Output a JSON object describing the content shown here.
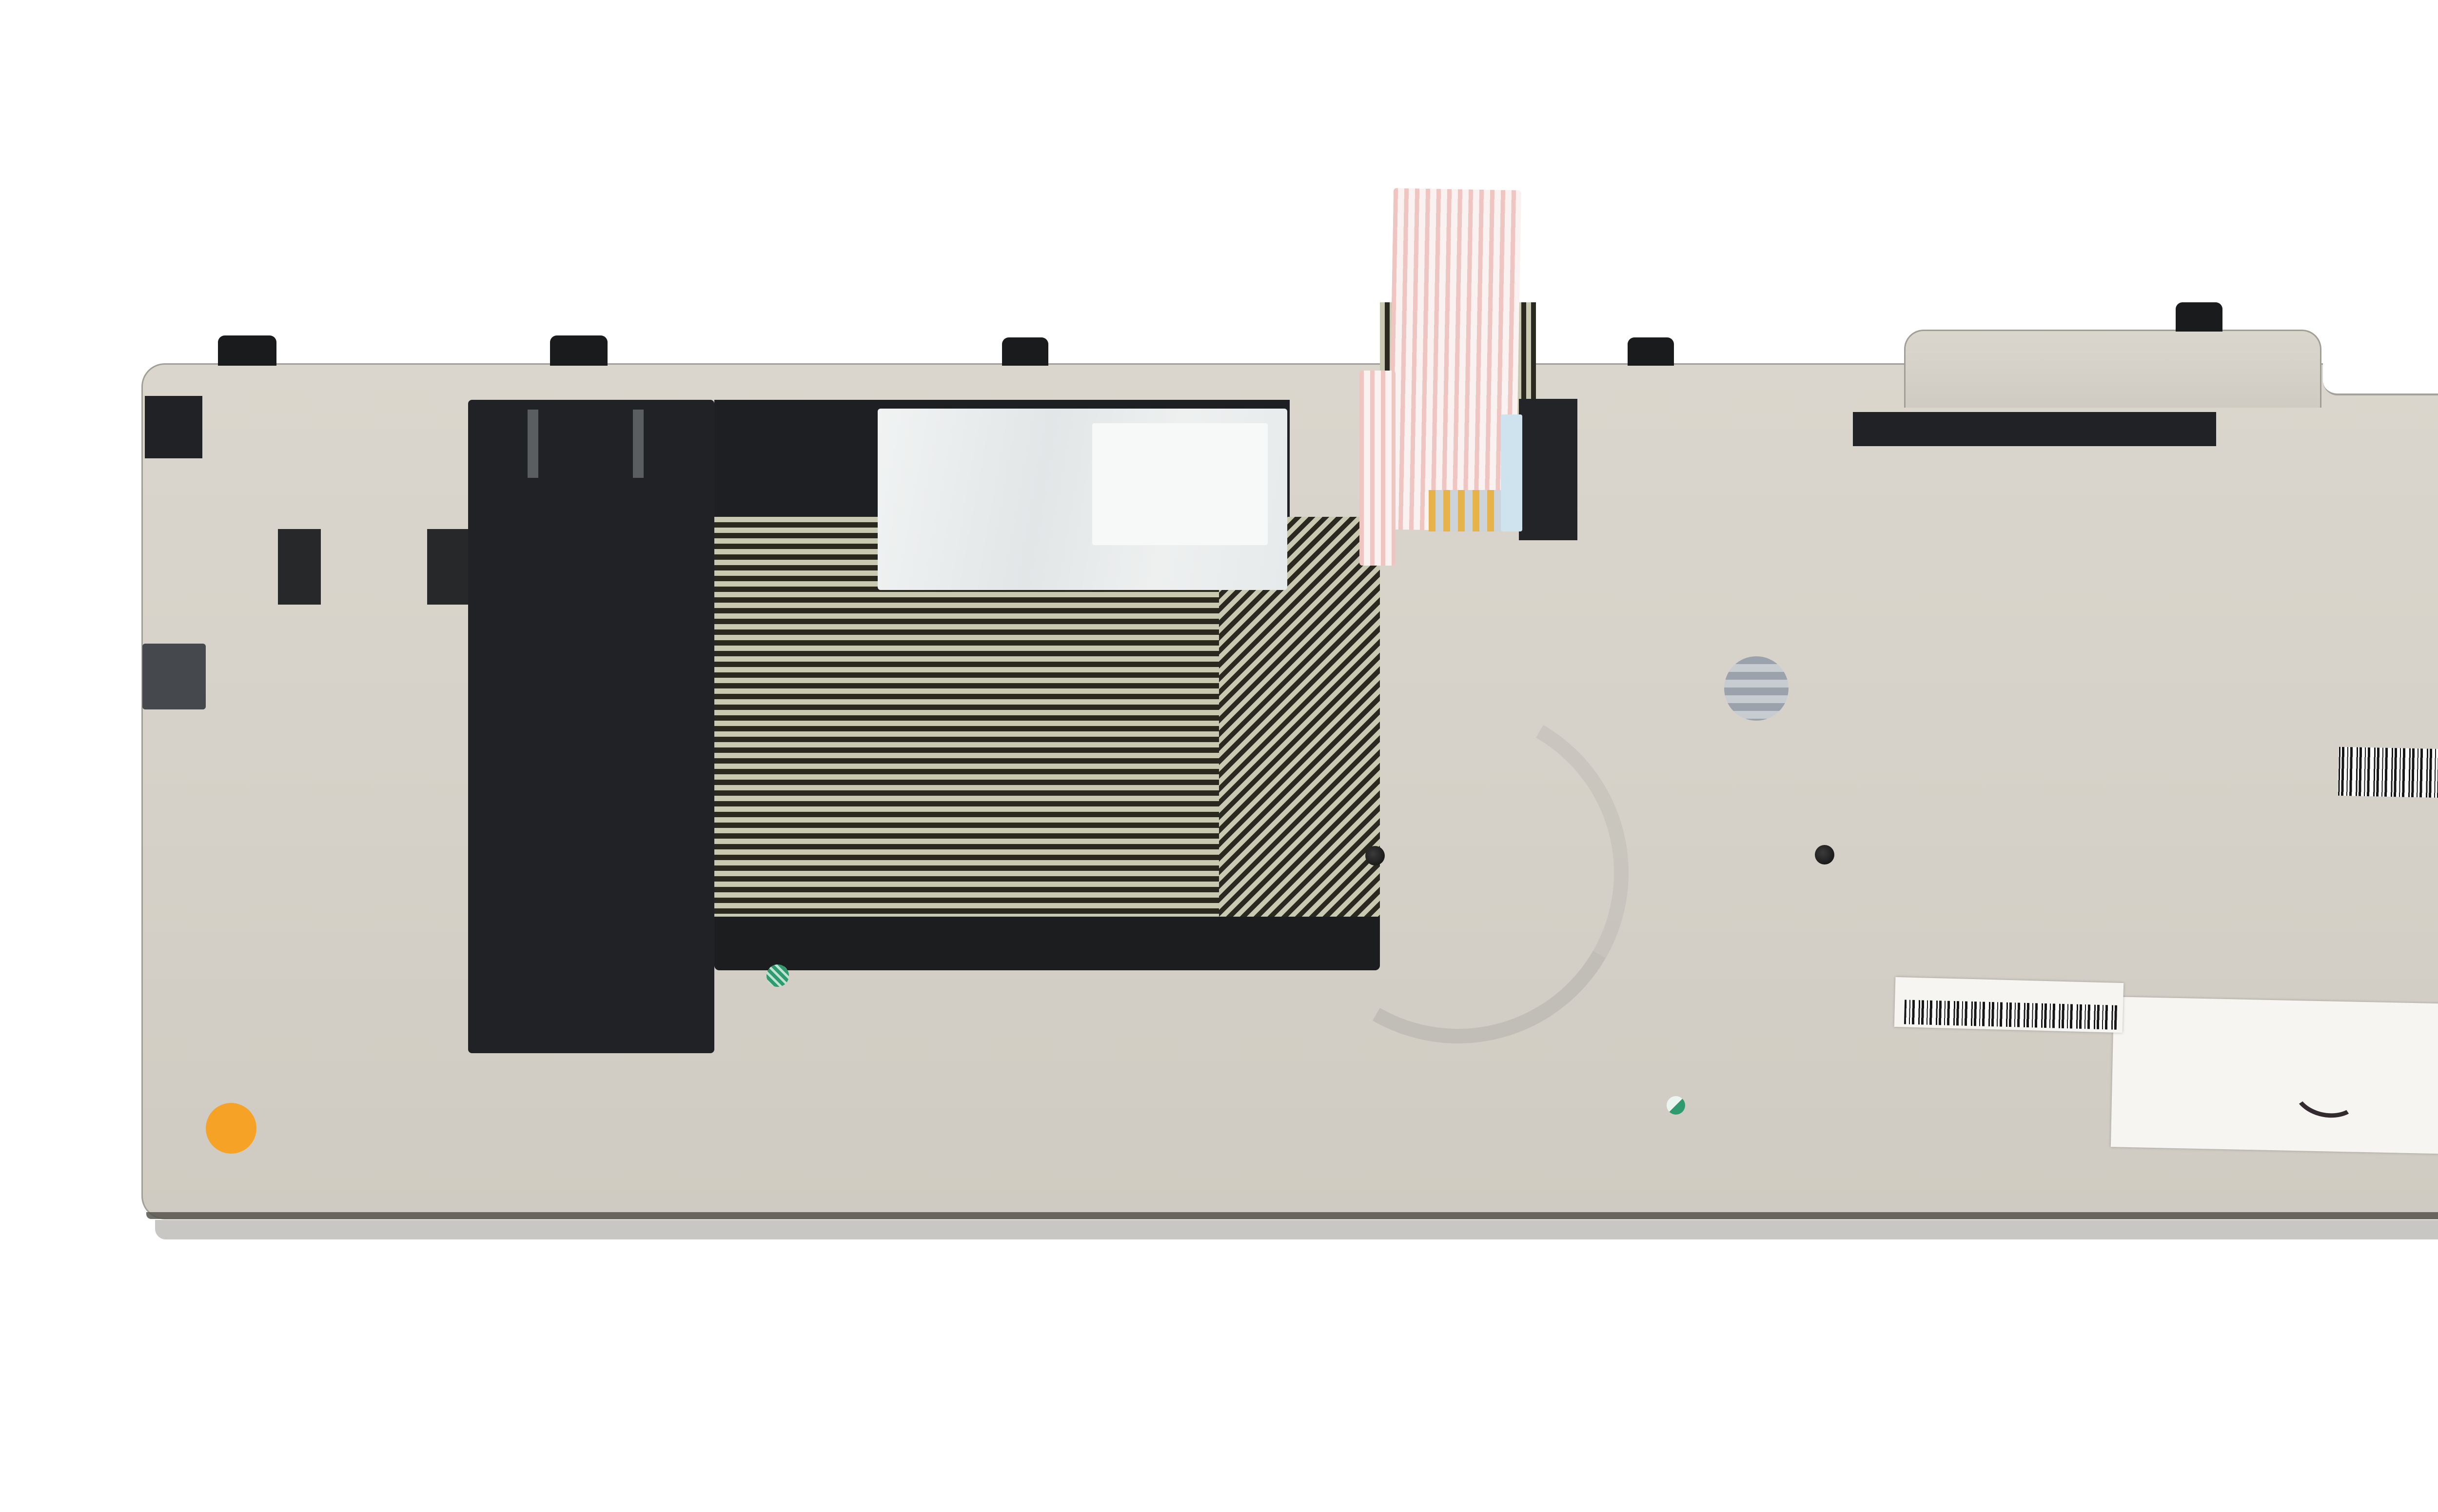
{
  "watermark": {
    "line1": "AGI",
    "line2": "PARTS"
  },
  "plate": {
    "stamp_top_right": "MP-12P5"
  },
  "ribbon": {
    "text_primary": "SLHC01",
    "text_secondary": "2016-",
    "mark_hf": "HF",
    "mark_092": "092",
    "mark_e30": "E30",
    "mark_atsu": "ATSU"
  },
  "spec_label": {
    "part_number": "0C44913AA",
    "model": "MP-12P53US-442W",
    "variant": "KM-105US",
    "revision": "REV.A",
    "grid_cols": [
      "F",
      "C",
      "A"
    ],
    "grid_row_1": "N",
    "grid_row_2": "R",
    "grid_split_top": "O",
    "grid_split_bottom": "D"
  },
  "fru_label": {
    "product_code": "6K.4LHKB.073",
    "fru": "FRU: 04Y2348",
    "origin": "Made in  China",
    "barcode_number": "27539311"
  },
  "main_label": {
    "parts_no_label": "PARTS NO.",
    "parts_no": "0C44913",
    "id_no_label": "ID NO.:",
    "id_no": "6AK0NP",
    "fru_no_label": "FRU   NO.",
    "fru_no": "04Y2348",
    "model_no_label": "MODEL NO.",
    "model_no": "KM-105US",
    "serial": "11S0C44913Z1ZPB36AK0NP",
    "origin": "Made in China",
    "ul_mark": "ЯU",
    "ul_c": "c",
    "ul_us": "us",
    "ul_code": "E164844",
    "id_code": "ID: CEM2M"
  },
  "void_label": {
    "code": "1-07-4370-00001",
    "note": "void if removed"
  }
}
